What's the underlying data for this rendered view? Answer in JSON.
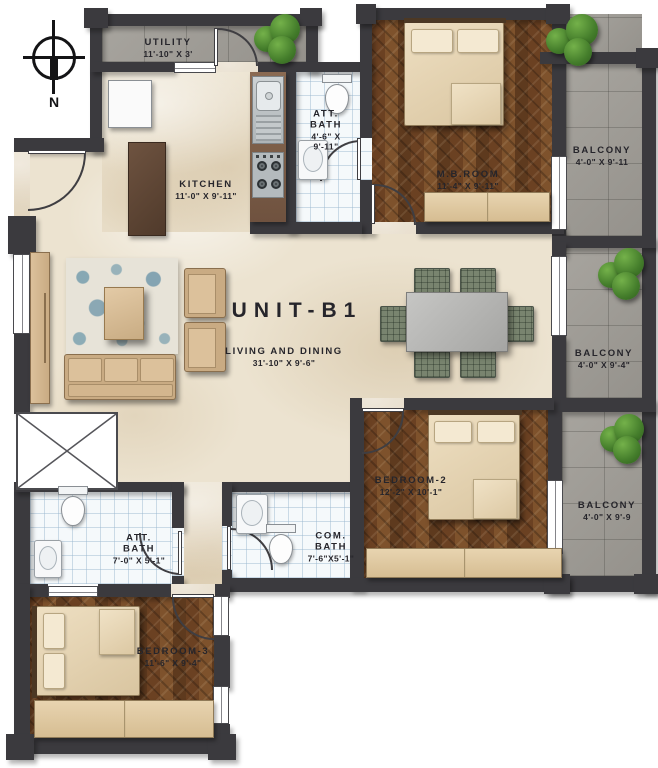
{
  "title": {
    "unit": "UNIT-B1"
  },
  "compass": {
    "north_label": "N"
  },
  "rooms": {
    "utility": {
      "name": "UTILITY",
      "dims": "11'-10\" X 3'"
    },
    "kitchen": {
      "name": "KITCHEN",
      "dims": "11'-0\" X 9'-11\""
    },
    "att_bath_top": {
      "name": "ATT. BATH",
      "dims": "4'-6\" X 9'-11\""
    },
    "mb_room": {
      "name": "M.B.ROOM",
      "dims": "11'-4\" X 9'-11\""
    },
    "balcony_top": {
      "name": "BALCONY",
      "dims": "4'-0\" X 9'-11"
    },
    "living_dining": {
      "name": "LIVING AND DINING",
      "dims": "31'-10\" X 9'-6\""
    },
    "balcony_mid": {
      "name": "BALCONY",
      "dims": "4'-0\" X 9'-4\""
    },
    "bedroom2": {
      "name": "BEDROOM-2",
      "dims": "12'-2\" X 10'-1\""
    },
    "balcony_bottom": {
      "name": "BALCONY",
      "dims": "4'-0\" X 9'-9"
    },
    "att_bath_bottom": {
      "name": "ATT. BATH",
      "dims": "7'-0\" X 5'-1\""
    },
    "com_bath": {
      "name": "COM. BATH",
      "dims": "7'-6\"X5'-1\""
    },
    "bedroom3": {
      "name": "BEDROOM-3",
      "dims": "11'-6\" X 9'-4\""
    }
  },
  "colors": {
    "wall": "#3b3a3e",
    "marble_floor": "#ece3d0",
    "wood_floor": "#6e4423",
    "bath_tile": "#f5f9fb",
    "concrete": "#a19e98",
    "furniture_tan": "#d9bd98",
    "dining_chair": "#79846f",
    "plant_green": "#447d2b",
    "label_text": "#26252b"
  }
}
